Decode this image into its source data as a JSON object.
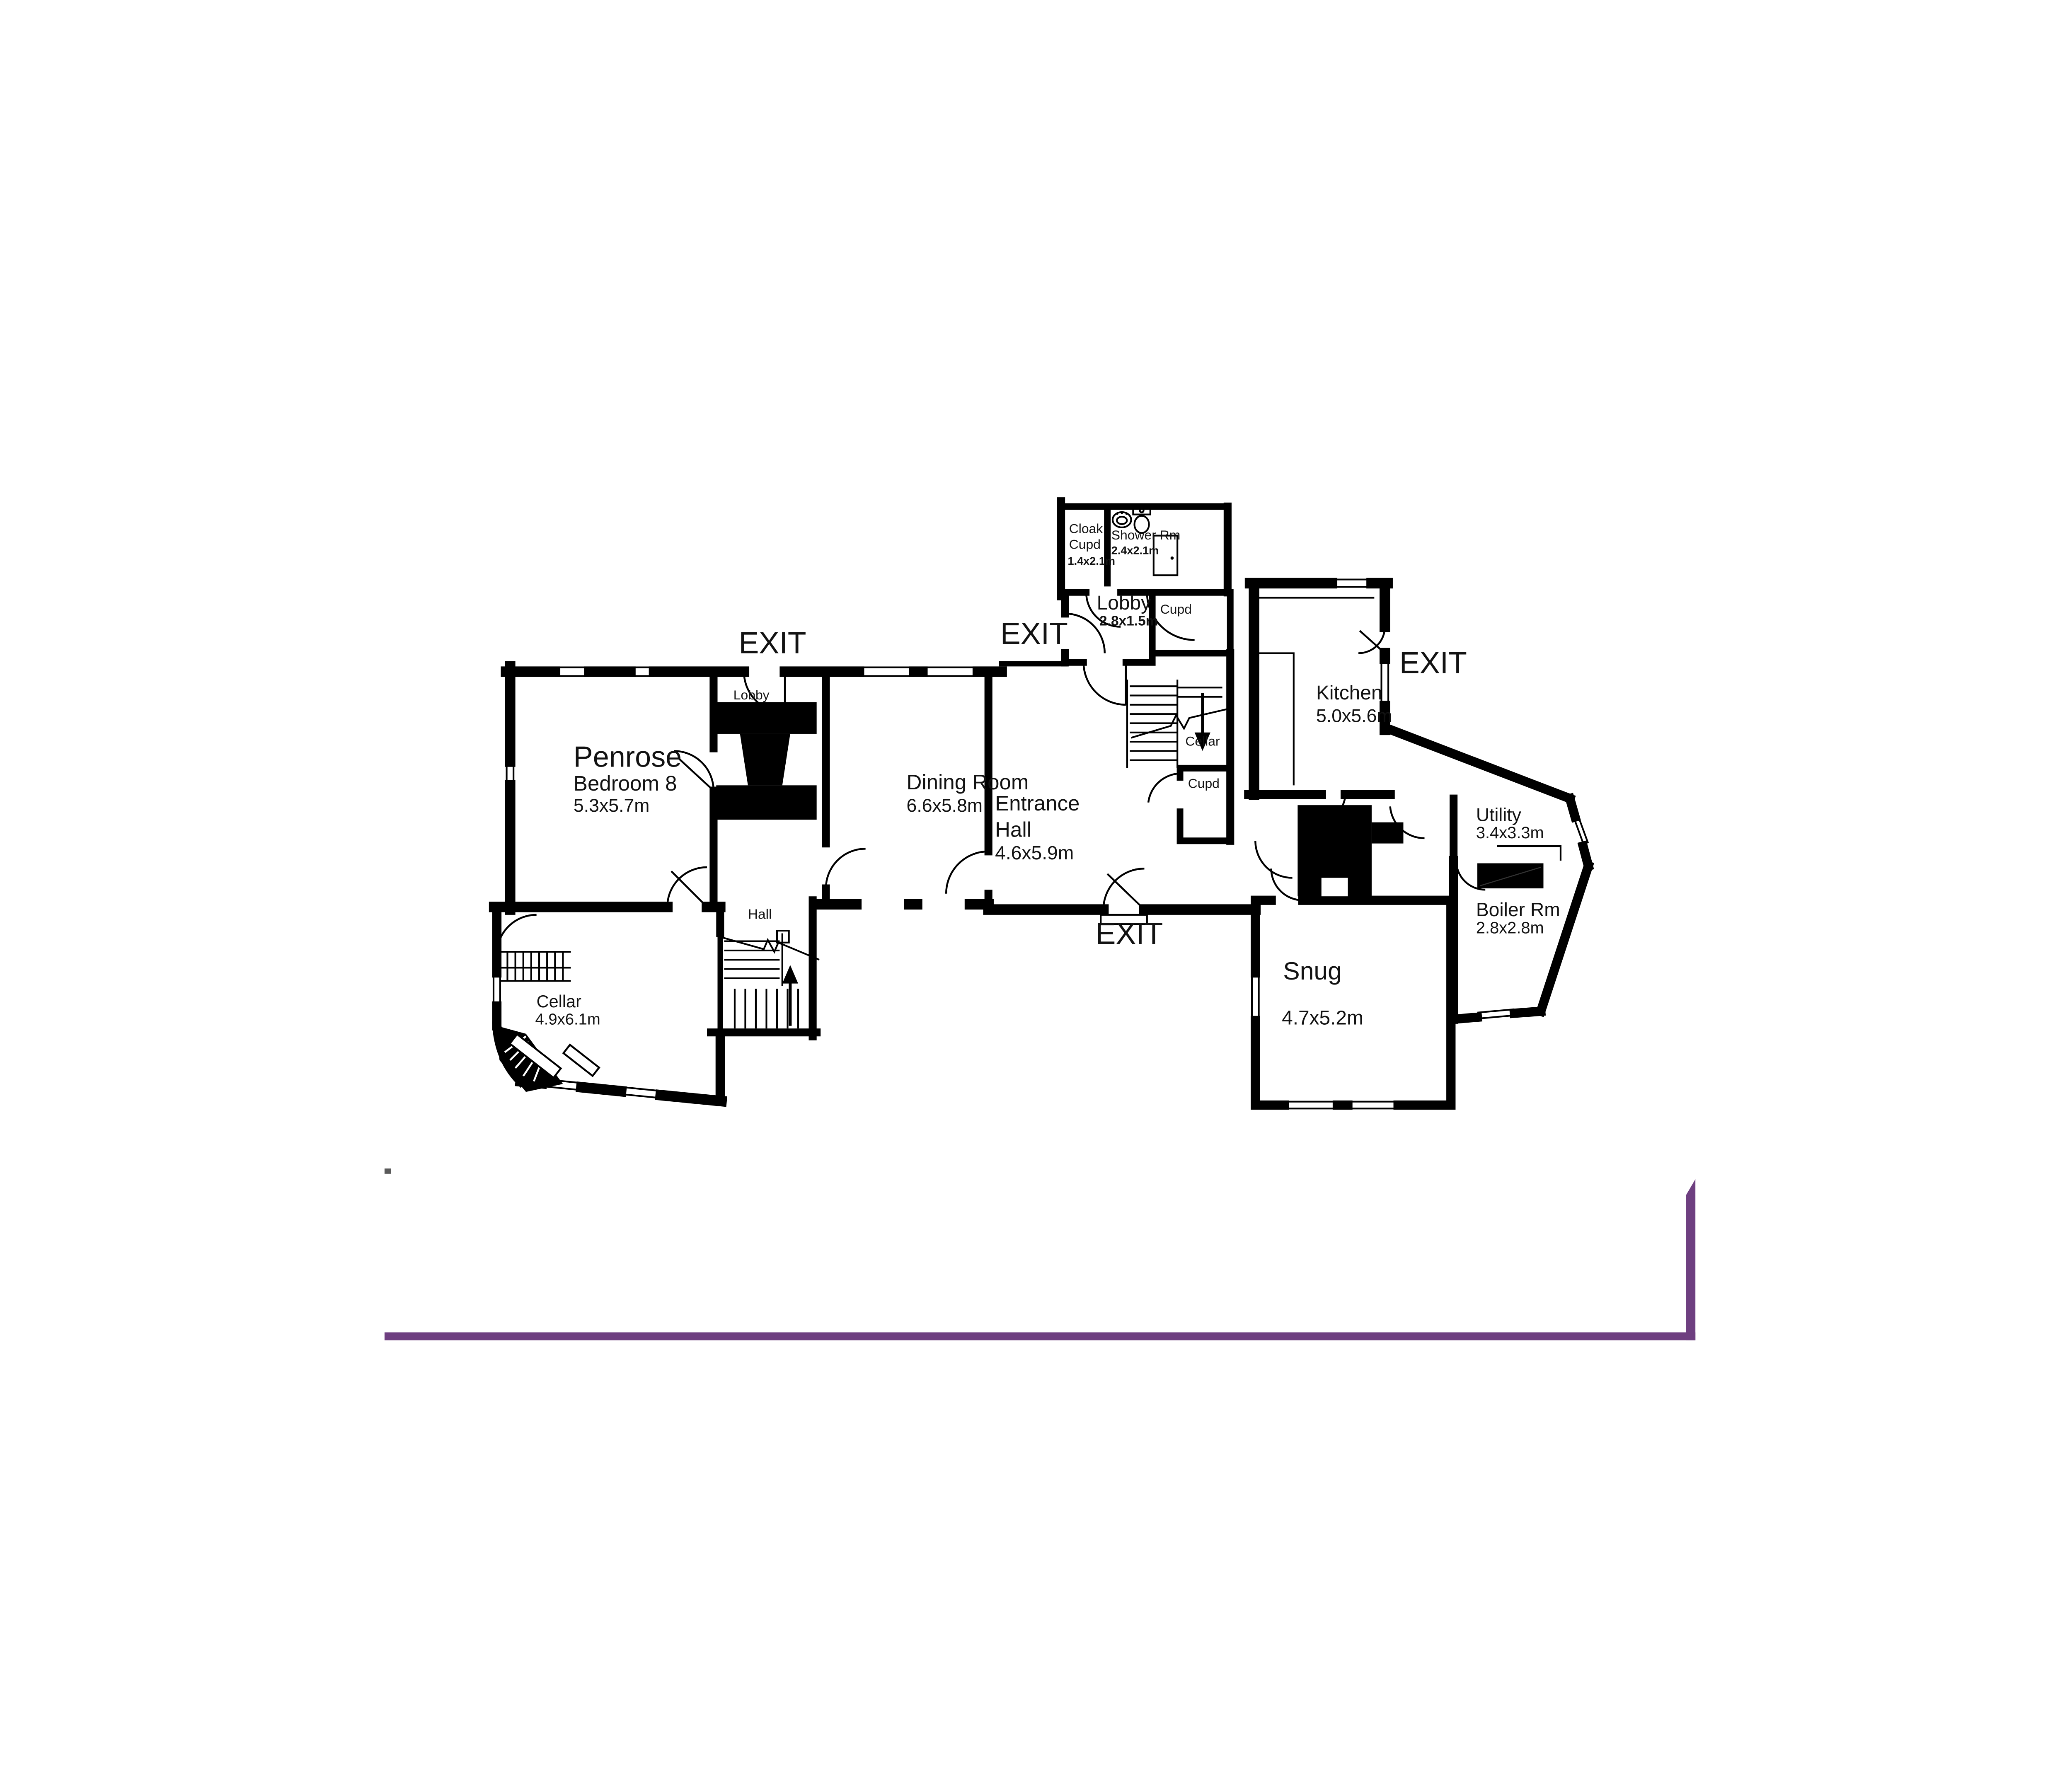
{
  "plan": {
    "property_name": "Penrose",
    "colors": {
      "wall": "#000000",
      "exit": "#e92128",
      "penrose": "#741a68",
      "border": "#6e3f80",
      "tick": "#5a5a5a",
      "label": "#121212"
    },
    "exit_label": "EXIT",
    "rooms": [
      {
        "id": "bedroom-8",
        "name": "Bedroom  8",
        "dims": "5.3x5.7m"
      },
      {
        "id": "dining-room",
        "name": "Dining  Room",
        "dims": "6.6x5.8m"
      },
      {
        "id": "entrance-hall",
        "name_line1": "Entrance",
        "name_line2": "Hall",
        "dims": "4.6x5.9m"
      },
      {
        "id": "kitchen",
        "name": "Kitchen",
        "dims": "5.0x5.6m"
      },
      {
        "id": "utility",
        "name": "Utility",
        "dims": "3.4x3.3m"
      },
      {
        "id": "boiler-room",
        "name": "Boiler Rm",
        "dims": "2.8x2.8m"
      },
      {
        "id": "snug",
        "name": "Snug",
        "dims": "4.7x5.2m"
      },
      {
        "id": "cellar",
        "name": "Cellar",
        "dims": "4.9x6.1m"
      },
      {
        "id": "lobby",
        "name": "Lobby",
        "dims": "2.8x1.5m"
      },
      {
        "id": "cloak-cupd",
        "name_line1": "Cloak",
        "name_line2": "Cupd",
        "dims": "1.4x2.1m"
      },
      {
        "id": "shower-room",
        "name": "Shower Rm",
        "dims": "2.4x2.1m"
      }
    ],
    "small_labels": {
      "lobby_small": "Lobby",
      "cupd_upper": "Cupd",
      "cupd_lower": "Cupd",
      "cellar_stairs": "Cellar",
      "hall": "Hall"
    }
  }
}
